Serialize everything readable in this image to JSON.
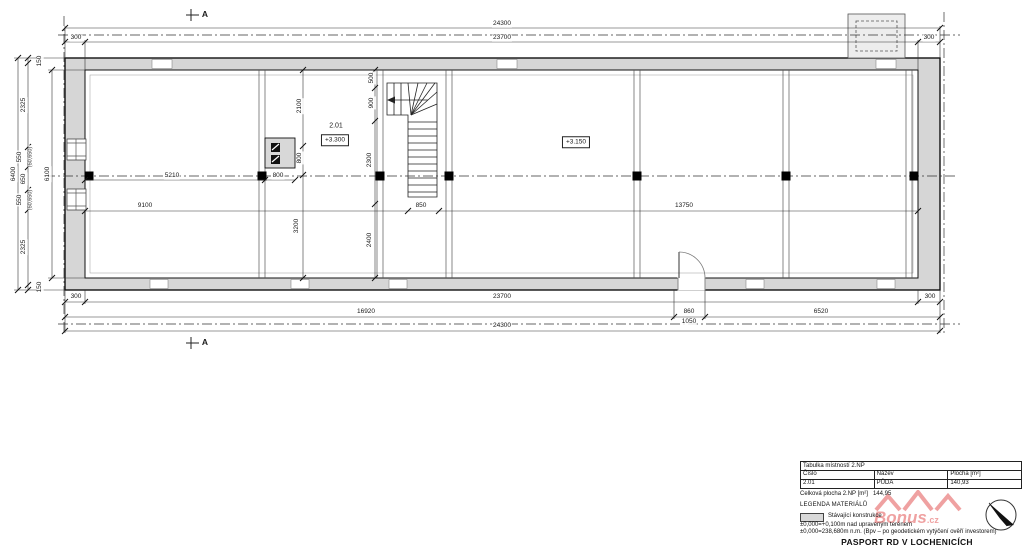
{
  "drawing": {
    "section_label": "A",
    "labels": [
      {
        "t": "24300",
        "x": 502,
        "y": 24,
        "n": "dim-overall-top"
      },
      {
        "t": "23700",
        "x": 502,
        "y": 38,
        "n": "dim-top"
      },
      {
        "t": "300",
        "x": 76,
        "y": 38
      },
      {
        "t": "300",
        "x": 929,
        "y": 38
      },
      {
        "t": "6400",
        "x": 14,
        "y": 174,
        "r": -90,
        "n": "dim-overall-left"
      },
      {
        "t": "6100",
        "x": 48,
        "y": 174,
        "r": -90
      },
      {
        "t": "150",
        "x": 40,
        "y": 61,
        "r": -90
      },
      {
        "t": "2325",
        "x": 24,
        "y": 105,
        "r": -90
      },
      {
        "t": "550",
        "x": 20,
        "y": 157,
        "r": -90
      },
      {
        "t": "(50,650)",
        "x": 31,
        "y": 157,
        "r": -90,
        "k": "paren"
      },
      {
        "t": "650",
        "x": 24,
        "y": 179,
        "r": -90
      },
      {
        "t": "550",
        "x": 20,
        "y": 200,
        "r": -90
      },
      {
        "t": "(50,650)",
        "x": 31,
        "y": 200,
        "r": -90,
        "k": "paren"
      },
      {
        "t": "2325",
        "x": 24,
        "y": 247,
        "r": -90
      },
      {
        "t": "150",
        "x": 40,
        "y": 287,
        "r": -90
      },
      {
        "t": "2100",
        "x": 300,
        "y": 106,
        "r": -90
      },
      {
        "t": "800",
        "x": 300,
        "y": 158,
        "r": -90
      },
      {
        "t": "3200",
        "x": 297,
        "y": 226,
        "r": -90
      },
      {
        "t": "500",
        "x": 372,
        "y": 78,
        "r": -90
      },
      {
        "t": "900",
        "x": 372,
        "y": 103,
        "r": -90
      },
      {
        "t": "2300",
        "x": 370,
        "y": 160,
        "r": -90
      },
      {
        "t": "2400",
        "x": 370,
        "y": 240,
        "r": -90
      },
      {
        "t": "5210",
        "x": 172,
        "y": 176
      },
      {
        "t": "800",
        "x": 278,
        "y": 176
      },
      {
        "t": "9100",
        "x": 145,
        "y": 206
      },
      {
        "t": "850",
        "x": 421,
        "y": 206
      },
      {
        "t": "13750",
        "x": 684,
        "y": 206
      },
      {
        "t": "2.01",
        "x": 336,
        "y": 126,
        "k": "room",
        "n": "room-number"
      },
      {
        "t": "+3.300",
        "x": 335,
        "y": 140,
        "k": "elev",
        "n": "elevation-label"
      },
      {
        "t": "+3.150",
        "x": 576,
        "y": 142,
        "k": "elev",
        "n": "elevation-label"
      },
      {
        "t": "300",
        "x": 76,
        "y": 297
      },
      {
        "t": "23700",
        "x": 502,
        "y": 297
      },
      {
        "t": "300",
        "x": 930,
        "y": 297
      },
      {
        "t": "16920",
        "x": 366,
        "y": 312
      },
      {
        "t": "860",
        "x": 689,
        "y": 312
      },
      {
        "t": "1050",
        "x": 689,
        "y": 322
      },
      {
        "t": "6520",
        "x": 821,
        "y": 312
      },
      {
        "t": "24300",
        "x": 502,
        "y": 326,
        "n": "dim-overall-bottom"
      },
      {
        "t": "A",
        "x": 205,
        "y": 14,
        "k": "section",
        "n": "section-marker-top"
      },
      {
        "t": "A",
        "x": 205,
        "y": 342,
        "k": "section",
        "n": "section-marker-bottom"
      }
    ]
  },
  "room_table": {
    "title": "Tabulka místností  2.NP",
    "col_number": "Číslo",
    "col_name": "Název",
    "col_area": "Plocha [m²]",
    "rows": [
      {
        "number": "2.01",
        "name": "PŮDA",
        "area": "140,93"
      }
    ],
    "total_label": "Celková plocha 2.NP [m²]",
    "total_value": "144,95"
  },
  "legend": {
    "title": "LEGENDA MATERIÁLŮ",
    "existing_label": "Stávající konstrukce",
    "note_elevation": "±0,000=+0,100m nad upraveným terénem",
    "note_altitude": "±0,000=238,680m n.m. (Bpv – po geodetickém vytýčení ověří investorem)"
  },
  "footer": {
    "title": "PASPORT RD V LOCHENICÍCH"
  },
  "watermark": {
    "text": "Bonus",
    "suffix": ".cz",
    "color": "#e04545"
  }
}
